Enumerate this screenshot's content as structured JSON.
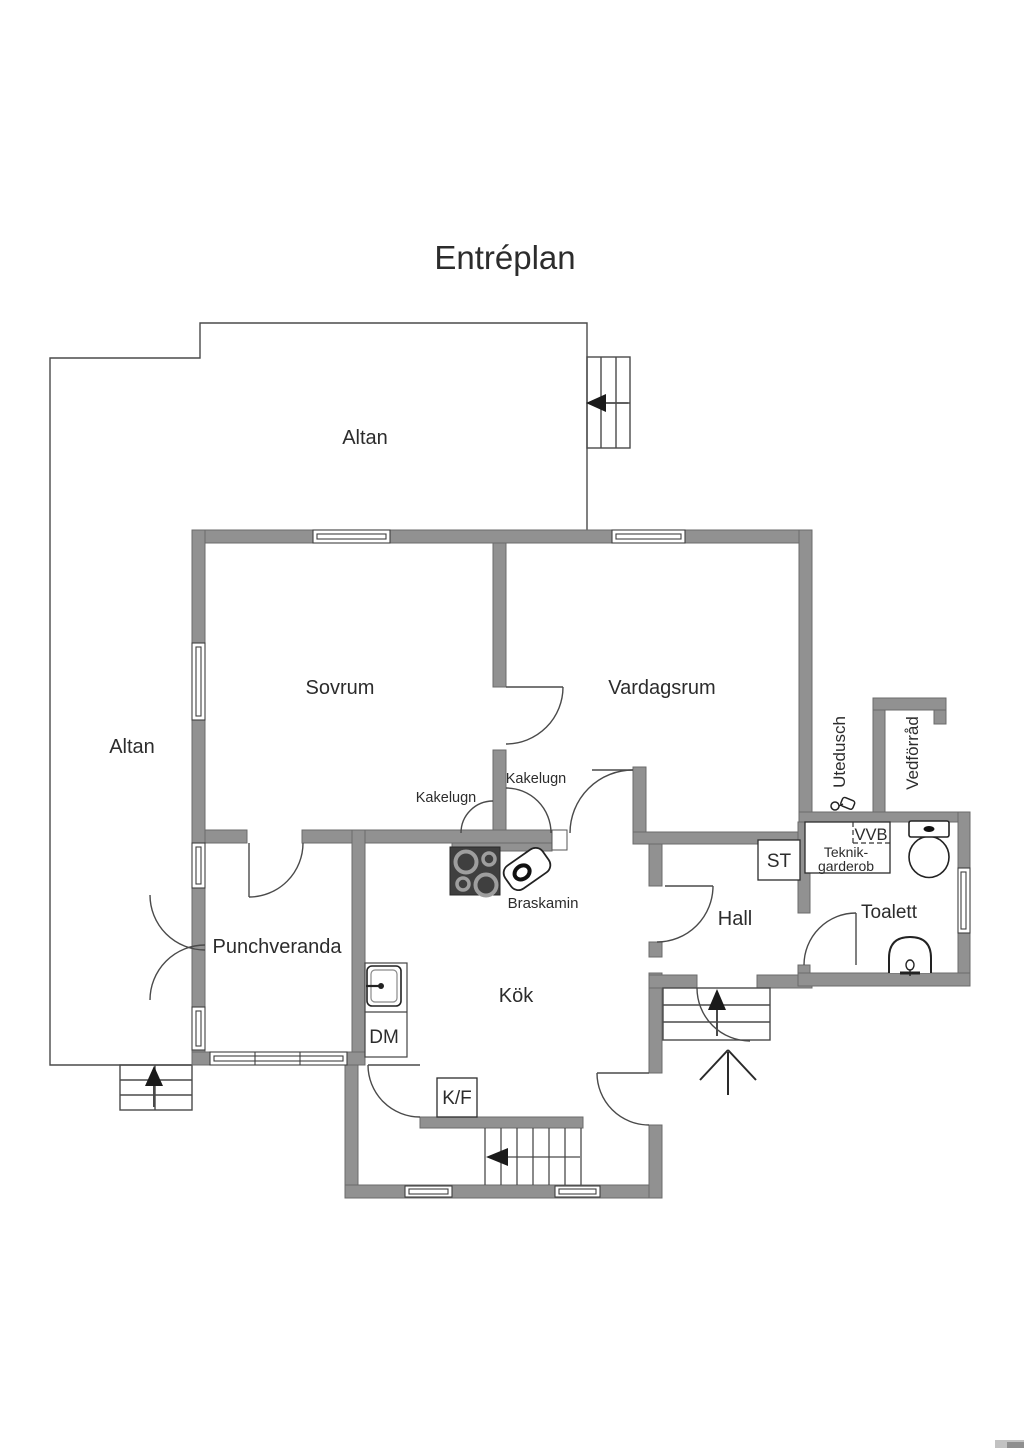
{
  "title": "Entréplan",
  "labels": {
    "altan_top": "Altan",
    "altan_side": "Altan",
    "sovrum": "Sovrum",
    "vardagsrum": "Vardagsrum",
    "punchveranda": "Punchveranda",
    "kok": "Kök",
    "hall": "Hall",
    "toalett": "Toalett",
    "kakelugn_left": "Kakelugn",
    "kakelugn_right": "Kakelugn",
    "braskamin": "Braskamin",
    "dm": "DM",
    "kf": "K/F",
    "st": "ST",
    "vvb": "VVB",
    "teknik_line1": "Teknik-",
    "teknik_line2": "garderob",
    "utedusch": "Utedusch",
    "vedforrad": "Vedförråd"
  },
  "colors": {
    "wall": "#919191",
    "wall_edge": "#6b6b6b",
    "thin_line": "#4a4a4a",
    "text": "#2c2c2c",
    "appliance_dark": "#3f3f3f"
  },
  "icons": {
    "stove": "stove-burners-icon",
    "braskamin": "wood-stove-icon",
    "toilet": "toilet-icon",
    "bathroom_sink": "sink-icon",
    "kitchen_sink": "kitchen-sink-icon",
    "shower": "shower-icon",
    "stair_arrows": "direction-arrow-icon",
    "entry_arrow": "entry-direction-icon"
  }
}
